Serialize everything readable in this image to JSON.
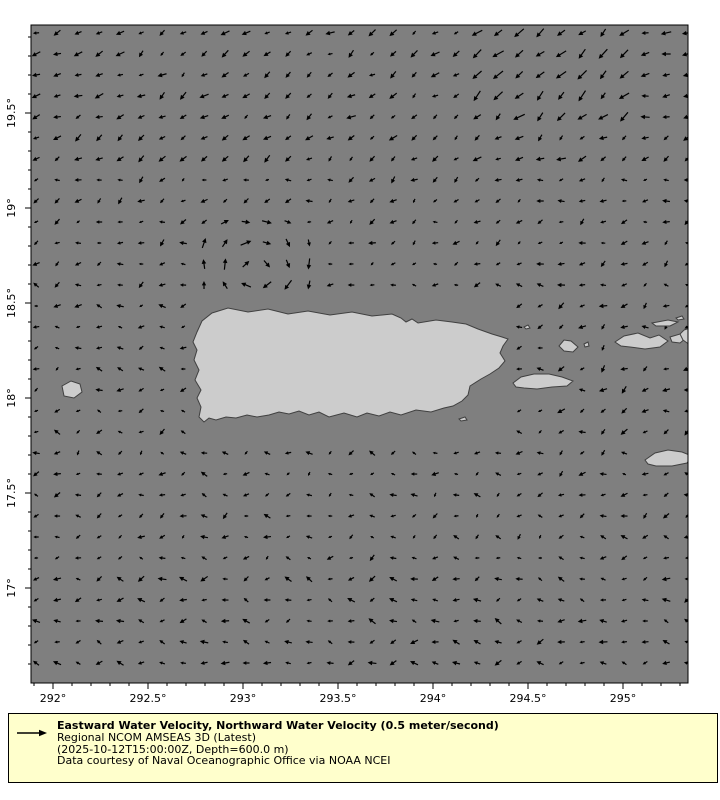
{
  "chart_data": {
    "type": "quiver",
    "description": "Ocean water velocity vector field map around Puerto Rico and the Virgin Islands",
    "legend": {
      "line1": "Eastward Water Velocity, Northward Water Velocity (0.5 meter/second)",
      "line2": "Regional NCOM AMSEAS 3D (Latest)",
      "line3": "(2025-10-12T15:00:00Z, Depth=600.0 m)",
      "line4": "Data courtesy of Naval Oceanographic Office via NOAA NCEI"
    },
    "colors": {
      "ocean": "#7f7f7f",
      "land": "#cccccc",
      "land_outline": "#404040",
      "arrow": "#000000",
      "legend_bg": "#ffffcc",
      "border": "#000000",
      "text": "#000000",
      "figure_bg": "#ffffff"
    },
    "plot": {
      "x": 31,
      "y": 25,
      "w": 657,
      "h": 658
    },
    "projection": {
      "x_ref": 53,
      "lon_ref": 292,
      "y_ref": 113,
      "lat_ref": 19.5,
      "px_per_deg": 190
    },
    "axes": {
      "lon_range": [
        291.88,
        295.34
      ],
      "lat_range": [
        16.5,
        19.96
      ],
      "x_major": [
        {
          "lon": 292.0,
          "label": "292°"
        },
        {
          "lon": 292.5,
          "label": "292.5°"
        },
        {
          "lon": 293.0,
          "label": "293°"
        },
        {
          "lon": 293.5,
          "label": "293.5°"
        },
        {
          "lon": 294.0,
          "label": "294°"
        },
        {
          "lon": 294.5,
          "label": "294.5°"
        },
        {
          "lon": 295.0,
          "label": "295°"
        }
      ],
      "y_major": [
        {
          "lat": 19.5,
          "label": "19.5°"
        },
        {
          "lat": 19.0,
          "label": "19°"
        },
        {
          "lat": 18.5,
          "label": "18.5°"
        },
        {
          "lat": 18.0,
          "label": "18°"
        },
        {
          "lat": 17.5,
          "label": "17.5°"
        },
        {
          "lat": 17.0,
          "label": "17°"
        }
      ],
      "x_minor_tenths": [
        2919,
        2953
      ],
      "y_minor_tenths": [
        165,
        199
      ],
      "major_tick_len": 6,
      "minor_tick_len": 3,
      "tick_font_size": 11
    },
    "grid": {
      "x0": 36,
      "y0": 33,
      "step": 21,
      "cols": 32,
      "rows": 31
    },
    "flow_model": {
      "seed": 7,
      "regions": [
        {
          "x1": 31,
          "y1": 25,
          "x2": 688,
          "y2": 683,
          "angle": 190,
          "spread": 50,
          "len": [
            4,
            8
          ]
        },
        {
          "x1": 31,
          "y1": 25,
          "x2": 688,
          "y2": 160,
          "angle": 215,
          "spread": 25,
          "len": [
            5,
            10
          ]
        },
        {
          "x1": 460,
          "y1": 25,
          "x2": 640,
          "y2": 130,
          "angle": 222,
          "spread": 18,
          "len": [
            8,
            13
          ]
        },
        {
          "x1": 640,
          "y1": 25,
          "x2": 688,
          "y2": 120,
          "angle": 188,
          "spread": 14,
          "len": [
            7,
            11
          ]
        },
        {
          "x1": 31,
          "y1": 25,
          "x2": 140,
          "y2": 120,
          "angle": 202,
          "spread": 18,
          "len": [
            6,
            10
          ]
        },
        {
          "x1": 31,
          "y1": 160,
          "x2": 688,
          "y2": 265,
          "angle": 205,
          "spread": 40,
          "len": [
            4,
            8
          ]
        },
        {
          "x1": 31,
          "y1": 440,
          "x2": 688,
          "y2": 565,
          "angle": 195,
          "spread": 55,
          "len": [
            4,
            8
          ]
        },
        {
          "x1": 31,
          "y1": 565,
          "x2": 688,
          "y2": 683,
          "angle": 182,
          "spread": 45,
          "len": [
            5,
            9
          ]
        },
        {
          "x1": 555,
          "y1": 300,
          "x2": 688,
          "y2": 470,
          "angle": 205,
          "spread": 45,
          "len": [
            5,
            9
          ]
        }
      ],
      "eddy": {
        "cx": 252,
        "cy": 272,
        "r": 66,
        "len": [
          7,
          12
        ],
        "jitter": 18
      },
      "mask_rects": [
        [
          186,
          300,
          516,
          432
        ],
        [
          508,
          371,
          580,
          394
        ],
        [
          553,
          334,
          592,
          359
        ],
        [
          610,
          329,
          695,
          354
        ],
        [
          640,
          444,
          695,
          470
        ],
        [
          56,
          377,
          90,
          403
        ]
      ]
    },
    "land": {
      "puerto-rico": [
        [
          212,
          313
        ],
        [
          228,
          308
        ],
        [
          248,
          312
        ],
        [
          268,
          309
        ],
        [
          288,
          314
        ],
        [
          308,
          311
        ],
        [
          330,
          315
        ],
        [
          352,
          312
        ],
        [
          372,
          316
        ],
        [
          392,
          314
        ],
        [
          401,
          318
        ],
        [
          406,
          322
        ],
        [
          412,
          319
        ],
        [
          418,
          323
        ],
        [
          436,
          320
        ],
        [
          452,
          322
        ],
        [
          466,
          324
        ],
        [
          478,
          329
        ],
        [
          492,
          334
        ],
        [
          502,
          337
        ],
        [
          508,
          339
        ],
        [
          503,
          346
        ],
        [
          500,
          353
        ],
        [
          505,
          361
        ],
        [
          499,
          368
        ],
        [
          490,
          374
        ],
        [
          481,
          379
        ],
        [
          470,
          386
        ],
        [
          468,
          395
        ],
        [
          462,
          401
        ],
        [
          453,
          406
        ],
        [
          444,
          408
        ],
        [
          431,
          412
        ],
        [
          416,
          410
        ],
        [
          401,
          415
        ],
        [
          390,
          412
        ],
        [
          379,
          416
        ],
        [
          367,
          413
        ],
        [
          357,
          417
        ],
        [
          344,
          413
        ],
        [
          329,
          417
        ],
        [
          319,
          412
        ],
        [
          309,
          415
        ],
        [
          299,
          411
        ],
        [
          289,
          414
        ],
        [
          279,
          412
        ],
        [
          269,
          415
        ],
        [
          257,
          417
        ],
        [
          247,
          415
        ],
        [
          236,
          418
        ],
        [
          226,
          417
        ],
        [
          216,
          420
        ],
        [
          209,
          418
        ],
        [
          204,
          422
        ],
        [
          199,
          417
        ],
        [
          201,
          407
        ],
        [
          197,
          398
        ],
        [
          201,
          390
        ],
        [
          195,
          380
        ],
        [
          199,
          370
        ],
        [
          194,
          360
        ],
        [
          197,
          350
        ],
        [
          193,
          342
        ],
        [
          197,
          332
        ],
        [
          202,
          321
        ]
      ],
      "vieques": [
        [
          513,
          383
        ],
        [
          521,
          377
        ],
        [
          534,
          374
        ],
        [
          549,
          374
        ],
        [
          562,
          377
        ],
        [
          573,
          381
        ],
        [
          567,
          386
        ],
        [
          552,
          387
        ],
        [
          537,
          389
        ],
        [
          524,
          388
        ],
        [
          516,
          387
        ]
      ],
      "culebra": [
        [
          559,
          346
        ],
        [
          564,
          340
        ],
        [
          571,
          341
        ],
        [
          578,
          347
        ],
        [
          573,
          352
        ],
        [
          564,
          351
        ]
      ],
      "culebrita": [
        [
          584,
          344
        ],
        [
          588,
          342
        ],
        [
          589,
          346
        ],
        [
          585,
          347
        ]
      ],
      "st-thomas": [
        [
          615,
          342
        ],
        [
          624,
          336
        ],
        [
          638,
          333
        ],
        [
          650,
          338
        ],
        [
          659,
          335
        ],
        [
          668,
          341
        ],
        [
          660,
          347
        ],
        [
          645,
          349
        ],
        [
          630,
          347
        ],
        [
          621,
          346
        ]
      ],
      "st-john": [
        [
          670,
          337
        ],
        [
          680,
          334
        ],
        [
          686,
          338
        ],
        [
          680,
          343
        ],
        [
          672,
          342
        ]
      ],
      "tortola": [
        [
          652,
          323
        ],
        [
          668,
          320
        ],
        [
          678,
          322
        ],
        [
          670,
          326
        ],
        [
          656,
          326
        ]
      ],
      "islet-ne": [
        [
          676,
          318
        ],
        [
          682,
          316
        ],
        [
          684,
          319
        ],
        [
          678,
          320
        ]
      ],
      "edge-island": [
        [
          684,
          330
        ],
        [
          690,
          328
        ],
        [
          690,
          345
        ],
        [
          683,
          340
        ],
        [
          680,
          334
        ]
      ],
      "st-croix": [
        [
          645,
          460
        ],
        [
          655,
          453
        ],
        [
          668,
          450
        ],
        [
          682,
          452
        ],
        [
          692,
          456
        ],
        [
          687,
          463
        ],
        [
          672,
          466
        ],
        [
          656,
          466
        ],
        [
          648,
          464
        ]
      ],
      "mona": [
        [
          62,
          386
        ],
        [
          71,
          381
        ],
        [
          80,
          384
        ],
        [
          82,
          392
        ],
        [
          74,
          398
        ],
        [
          64,
          396
        ]
      ],
      "islet-east-tip": [
        [
          524,
          327
        ],
        [
          528,
          325
        ],
        [
          530,
          328
        ],
        [
          526,
          329
        ]
      ],
      "caja-de-muertos": [
        [
          459,
          419
        ],
        [
          465,
          417
        ],
        [
          467,
          420
        ],
        [
          461,
          421
        ]
      ]
    }
  }
}
